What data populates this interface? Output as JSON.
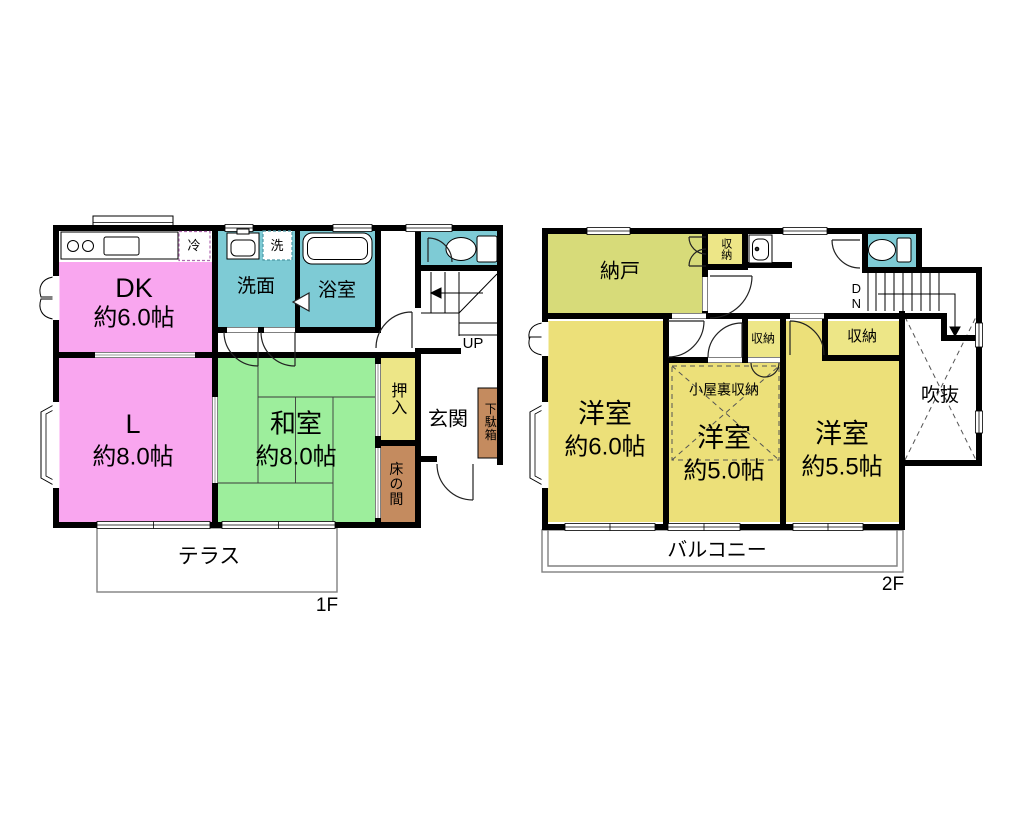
{
  "floor1": {
    "label": "1F",
    "dk": {
      "name": "DK",
      "size": "約6.0帖"
    },
    "living": {
      "name": "L",
      "size": "約8.0帖"
    },
    "washitsu": {
      "name": "和室",
      "size": "約8.0帖"
    },
    "senmen": "洗面",
    "yokushitsu": "浴室",
    "oshiire": "押入",
    "tokonoma": "床の間",
    "genkan": "玄関",
    "getabako": "下駄箱",
    "fridge": "冷",
    "washer": "洗",
    "stairs_up": "UP",
    "terrace": "テラス"
  },
  "floor2": {
    "label": "2F",
    "nando": "納戸",
    "closet_top": "収納",
    "closet_mid": "収納",
    "closet_right": "収納",
    "attic": "小屋裏収納",
    "room1": {
      "name": "洋室",
      "size": "約6.0帖"
    },
    "room2": {
      "name": "洋室",
      "size": "約5.0帖"
    },
    "room3": {
      "name": "洋室",
      "size": "約5.5帖"
    },
    "void": "吹抜",
    "balcony": "バルコニー",
    "stairs_down": "DN"
  },
  "colors": {
    "pink": "#F9A6EF",
    "tatami_green": "#9DEE9C",
    "wet_teal": "#7ECBD5",
    "western_yellow": "#ECE079",
    "storage_olive": "#D7DB79",
    "closet_yellow": "#EDE687",
    "wood_brown": "#C48B5F",
    "wall_black": "#000000",
    "line_gray": "#808080",
    "fridge_dash": "#B06AB0",
    "washer_dash": "#4B98A5"
  }
}
